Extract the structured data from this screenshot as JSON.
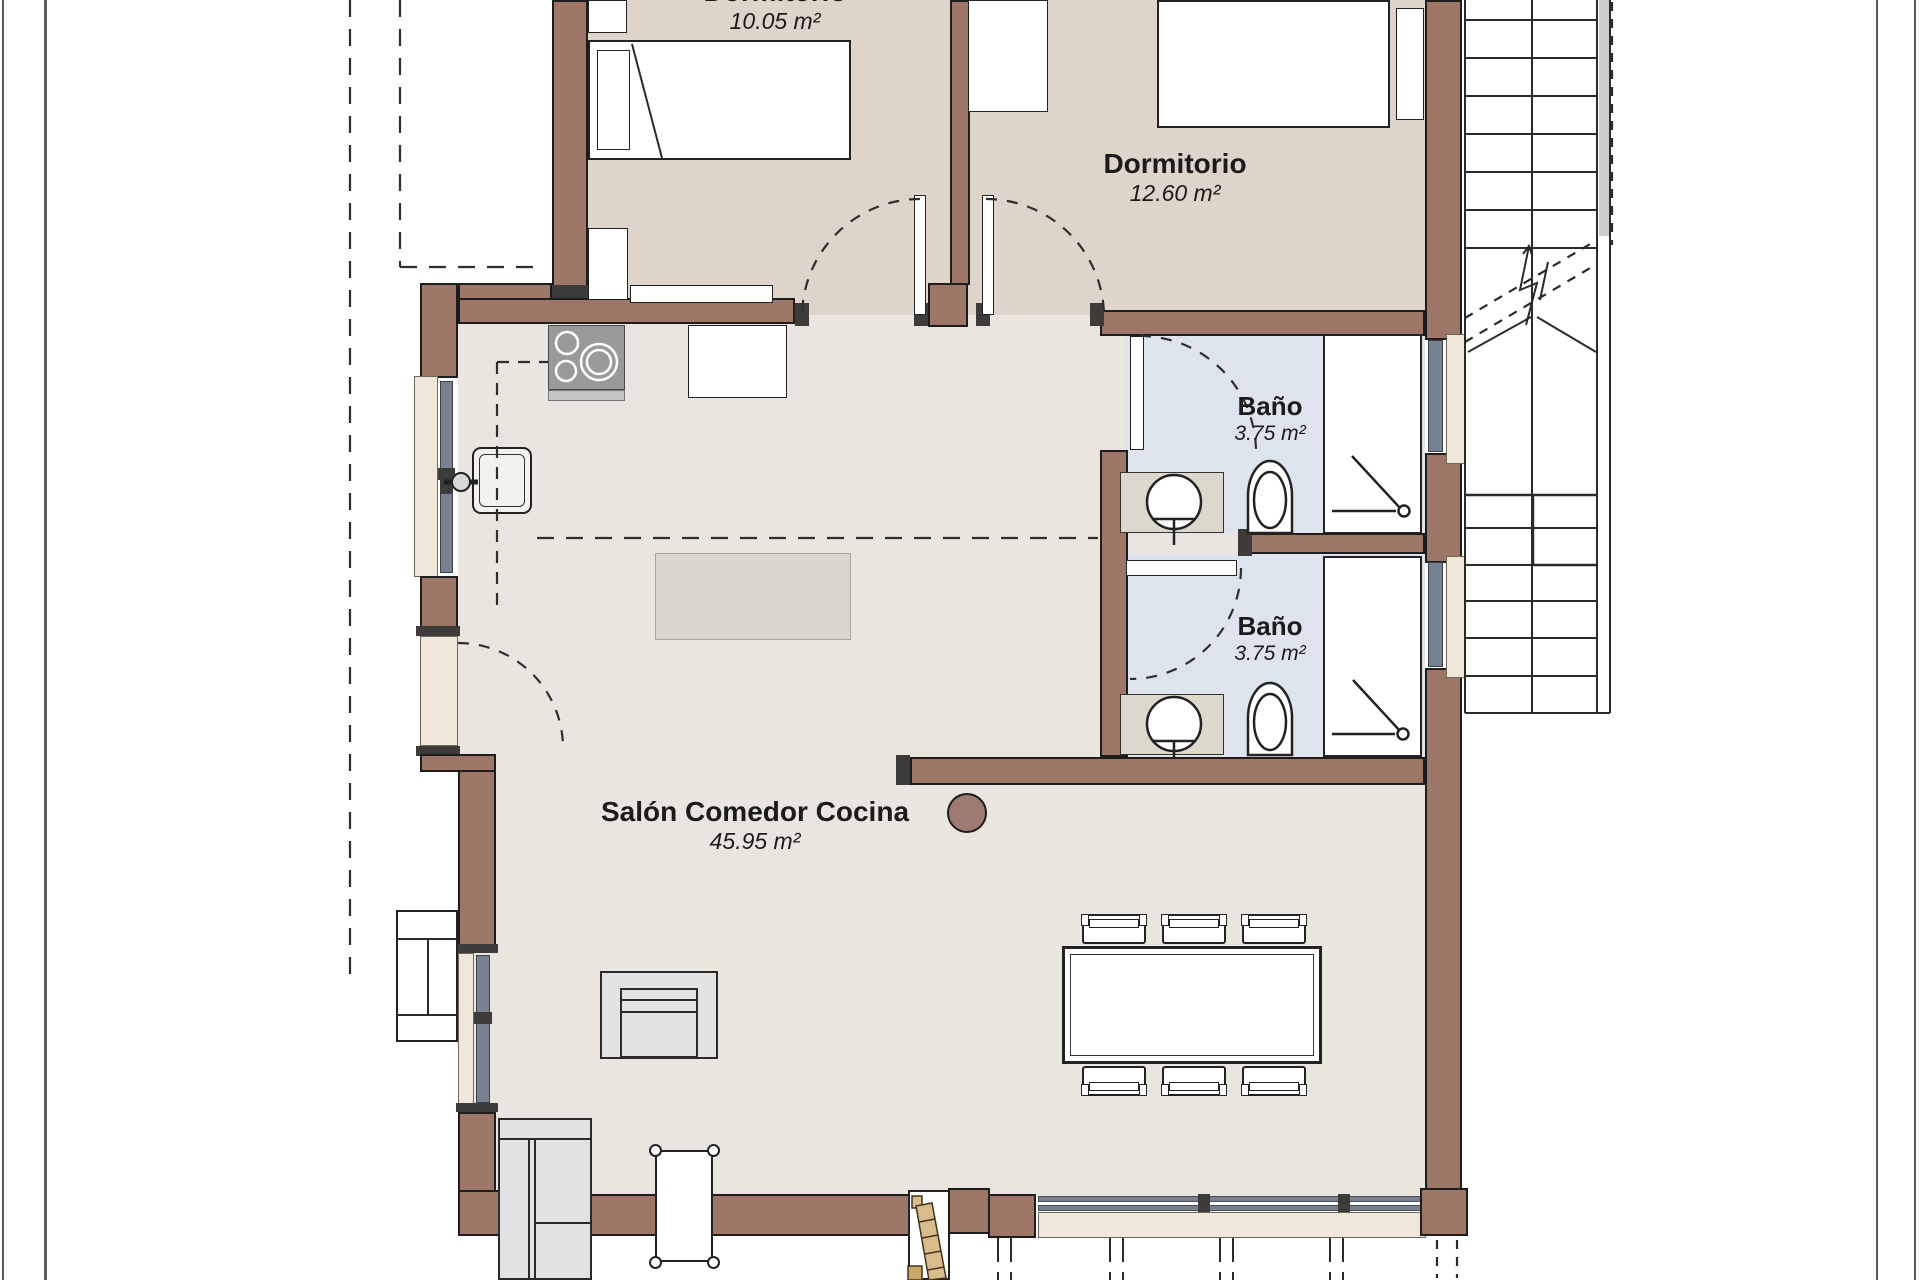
{
  "plan_title": "floor-plan",
  "rooms": {
    "bedroom1": {
      "name": "Dormitorio",
      "area": "10.05 m²"
    },
    "bedroom2": {
      "name": "Dormitorio",
      "area": "12.60 m²"
    },
    "bath1": {
      "name": "Baño",
      "area": "3.75 m²"
    },
    "bath2": {
      "name": "Baño",
      "area": "3.75 m²"
    },
    "living": {
      "name": "Salón Comedor Cocina",
      "area": "45.95 m²"
    }
  },
  "palette": {
    "wall": "#9e7668",
    "bedroom_floor": "#ded4c9",
    "living_floor": "#eae6df",
    "bath_floor": "#dee4ee",
    "window_glazing": "#79818f",
    "sill_beige": "#efe8da",
    "ladder_wood": "#d9bc8c",
    "column": "#9e7b72"
  }
}
